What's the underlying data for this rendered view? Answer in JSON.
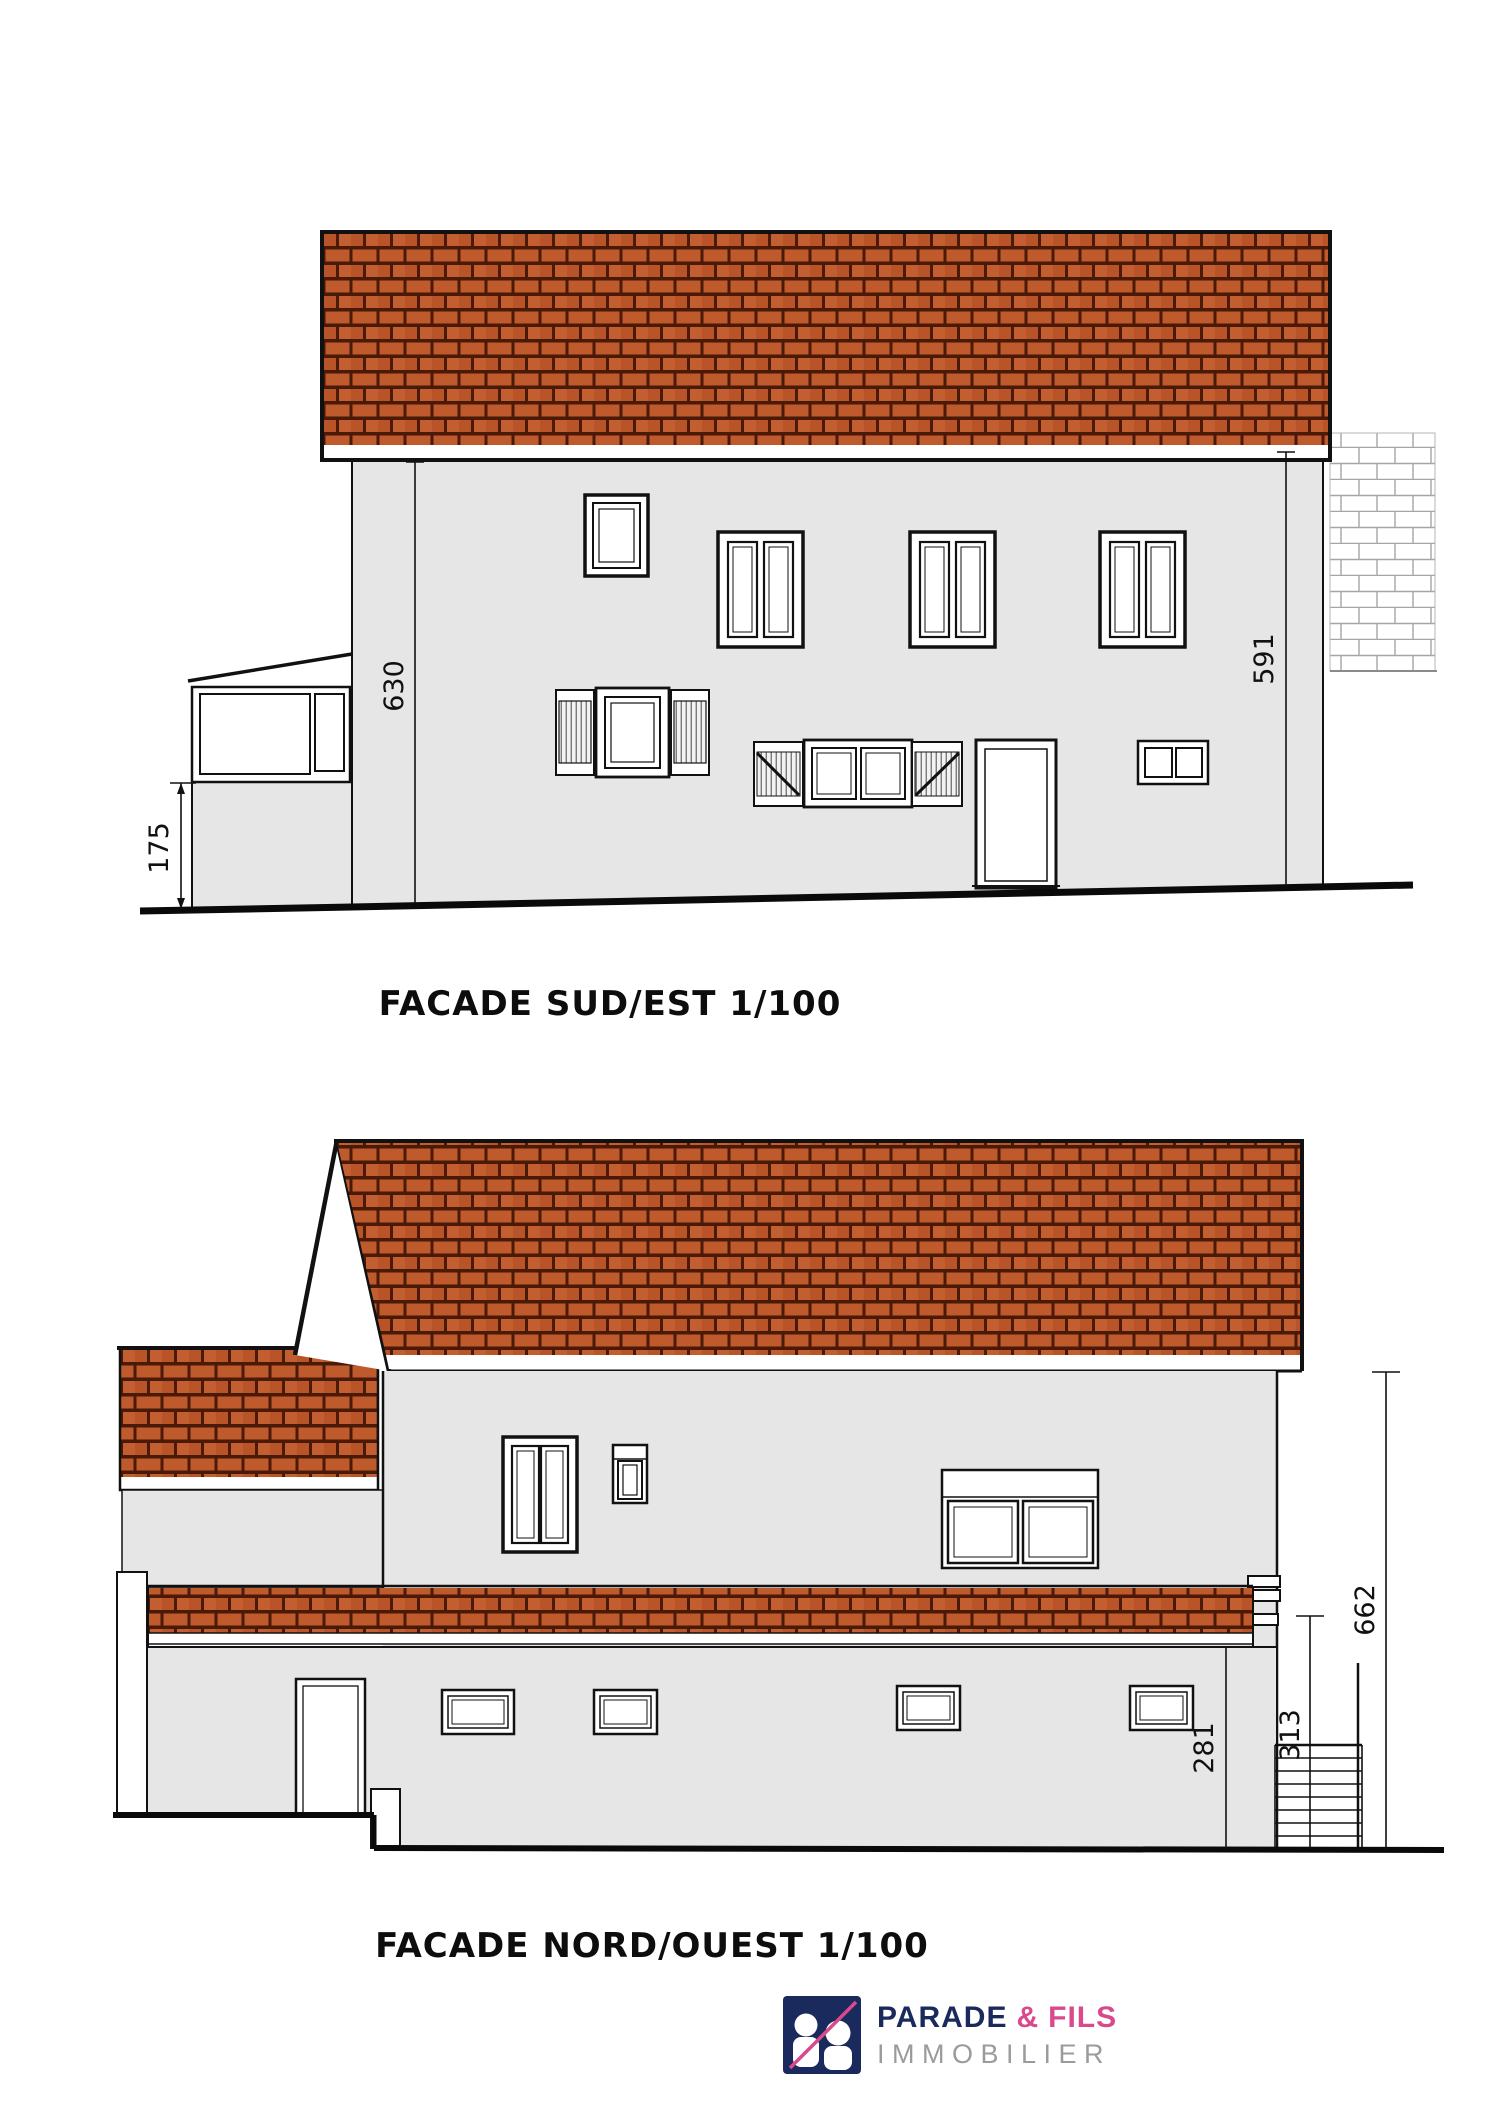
{
  "colors": {
    "roof_brick": "#bf5a2c",
    "roof_mortar": "#4a1a07",
    "wall_fill": "#e6e6e6",
    "line": "#111111",
    "stone_line": "#a5a5a5",
    "brand_navy": "#1b2a5c",
    "brand_pink": "#d84a8b",
    "tagline_gray": "#9b9b9b"
  },
  "facade_sud_est": {
    "title": "FACADE SUD/EST 1/100",
    "dimensions": {
      "wall_height_left": "630",
      "veranda_height": "175",
      "wall_height_right": "591"
    }
  },
  "facade_nord_ouest": {
    "title": "FACADE NORD/OUEST 1/100",
    "dimensions": {
      "total_height": "662",
      "stair_height": "313",
      "lower_wall_height": "281"
    }
  },
  "logo": {
    "name_primary": "PARADE",
    "ampersand": "&",
    "name_secondary": "FILS",
    "tagline": "IMMOBILIER"
  }
}
